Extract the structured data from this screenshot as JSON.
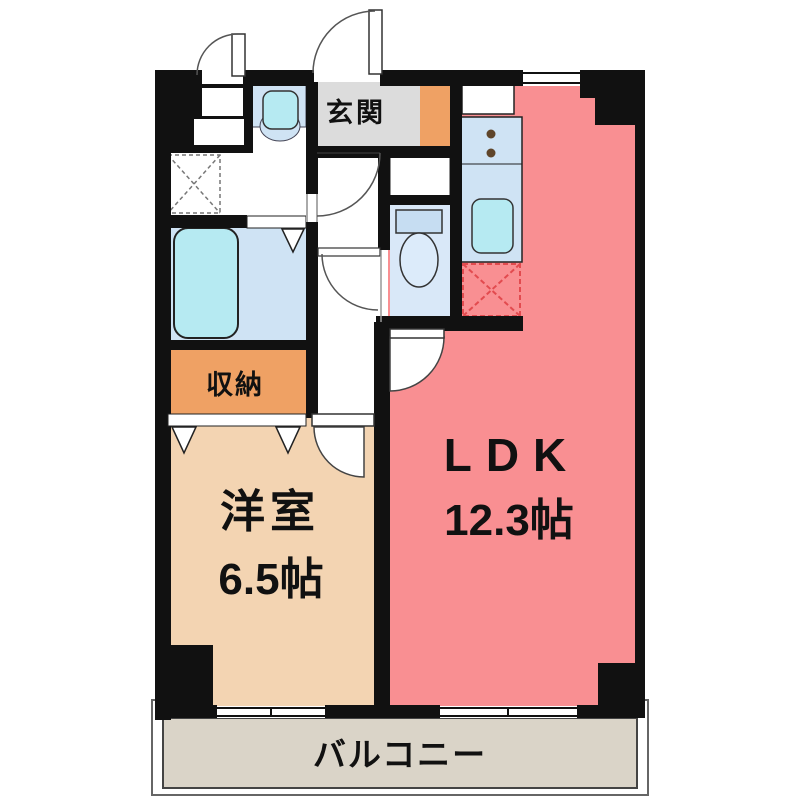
{
  "plan": {
    "title": "apartment-floor-plan",
    "rooms": {
      "entrance": {
        "label": "玄関"
      },
      "storage": {
        "label": "収納"
      },
      "western_room": {
        "label": "洋室",
        "size": "6.5帖"
      },
      "ldk": {
        "label": "LDK",
        "size": "12.3帖"
      },
      "balcony": {
        "label": "バルコニー"
      }
    },
    "colors": {
      "wall": "#111111",
      "ldk": "#f98f92",
      "western": "#f3d4b2",
      "storage": "#efa164",
      "entrance": "#dcdcdc",
      "accent": "#efa164",
      "water_floor": "#cfe3f4",
      "toilet_floor": "#d9e8f8",
      "fixture": "#b6eaf2",
      "tank": "#c6ddf2",
      "bowl": "#dcebfa",
      "balcony": "#dad4c8",
      "fridge_dash": "#e24b4f",
      "laundry_dash": "#777777",
      "burner": "#5f452a"
    }
  }
}
